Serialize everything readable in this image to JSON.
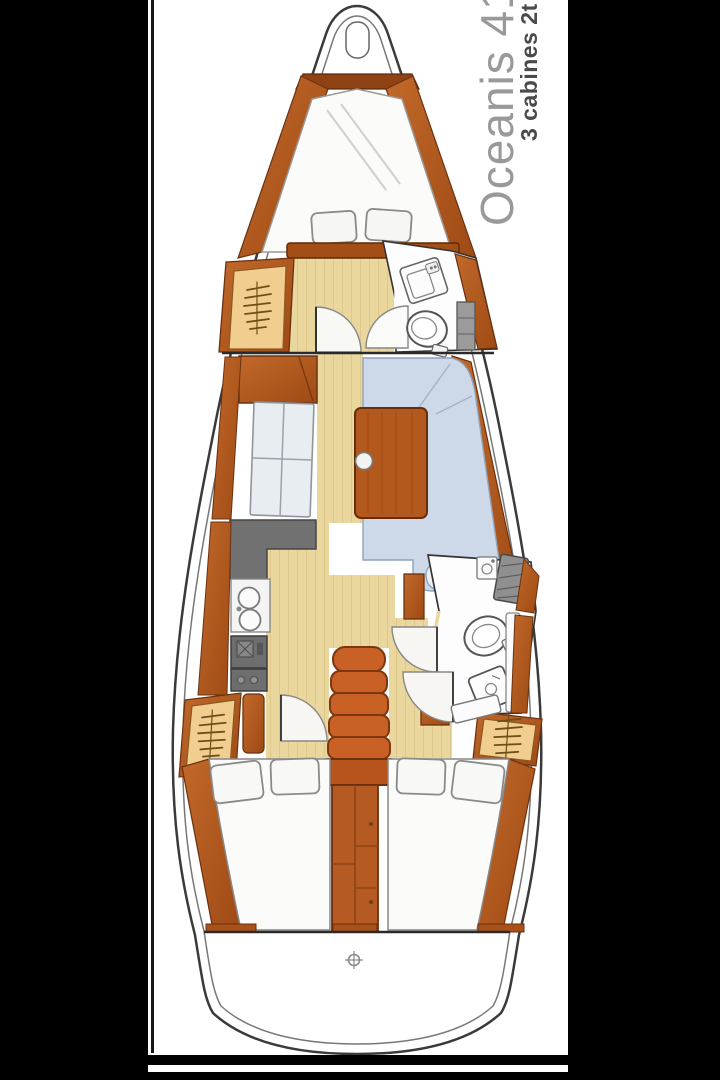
{
  "labels": {
    "title": "Oceanis 41",
    "subtitle": "3 cabines 2t"
  },
  "style": {
    "title_color": "#999999",
    "subtitle_color": "#4a4a4a",
    "page_background": "#ffffff",
    "masking_bar_color": "#000000",
    "wood_color": "#b4591e",
    "stairs_color": "#c96127",
    "floor_color": "#e9d79e",
    "upholstery_blue": "#cdd9e8",
    "mattress_white": "#fbfbfa",
    "counter_gray": "#707070",
    "locker_tan": "#f1cd90"
  },
  "diagram": {
    "type": "sailboat-interior-floor-plan",
    "orientation": "bow-up",
    "cabins": 3,
    "heads": 2,
    "features": [
      "anchor-locker",
      "forward-v-berth",
      "berth-pillows",
      "hanging-locker-port-forward",
      "forward-head-sink",
      "forward-head-toilet",
      "forward-head-shelf",
      "cabin-door-swing",
      "salon-settee-port",
      "salon-table",
      "table-knob",
      "dinette-settee-starboard",
      "galley-counter",
      "galley-double-sink",
      "galley-stove",
      "galley-oven",
      "companionway-stairs",
      "engine-compartment",
      "nav-seat",
      "aft-head-shower-seat",
      "aft-head-sink",
      "aft-head-toilet",
      "aft-head-basin",
      "aft-head-door",
      "aft-cabin-berth-port",
      "aft-cabin-berth-starboard",
      "hanging-locker-port-aft",
      "hanging-locker-starboard-aft",
      "transom",
      "stern-fitting"
    ]
  }
}
